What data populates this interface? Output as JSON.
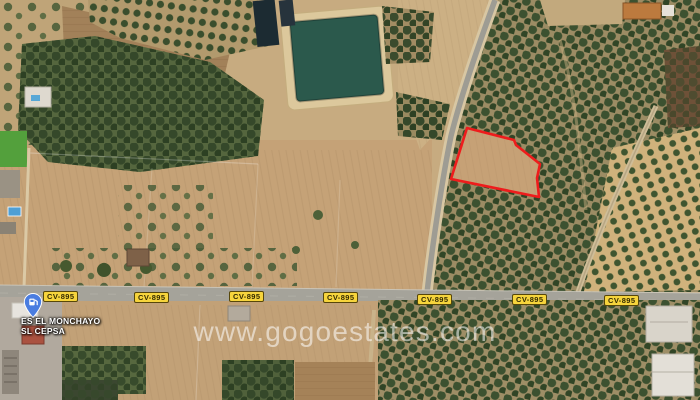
{
  "map": {
    "view": "satellite",
    "watermark_text": "www.gogoestates.com",
    "road_badge": {
      "label": "CV-895",
      "count": 7,
      "background_color": "#f6d43c"
    },
    "place_marker": {
      "icon": "fuel-station-pin",
      "pin_color": "#4a7de0",
      "label_line1": "ES EL MONCHAYO",
      "label_line2": "SL CEPSA"
    },
    "parcel": {
      "outline_color": "#ee1c1c",
      "fill_color": "#c6a176",
      "points": "451,179 467,128 514,140 516,145 540,164 537,178 539,197"
    },
    "terrain_colors": {
      "field_tan": "#c7ab80",
      "plowed_pink": "#c5a277",
      "orchard_green": "#35482a",
      "reservoir_water": "#2b594c",
      "road_gray": "#a5a39a"
    }
  }
}
